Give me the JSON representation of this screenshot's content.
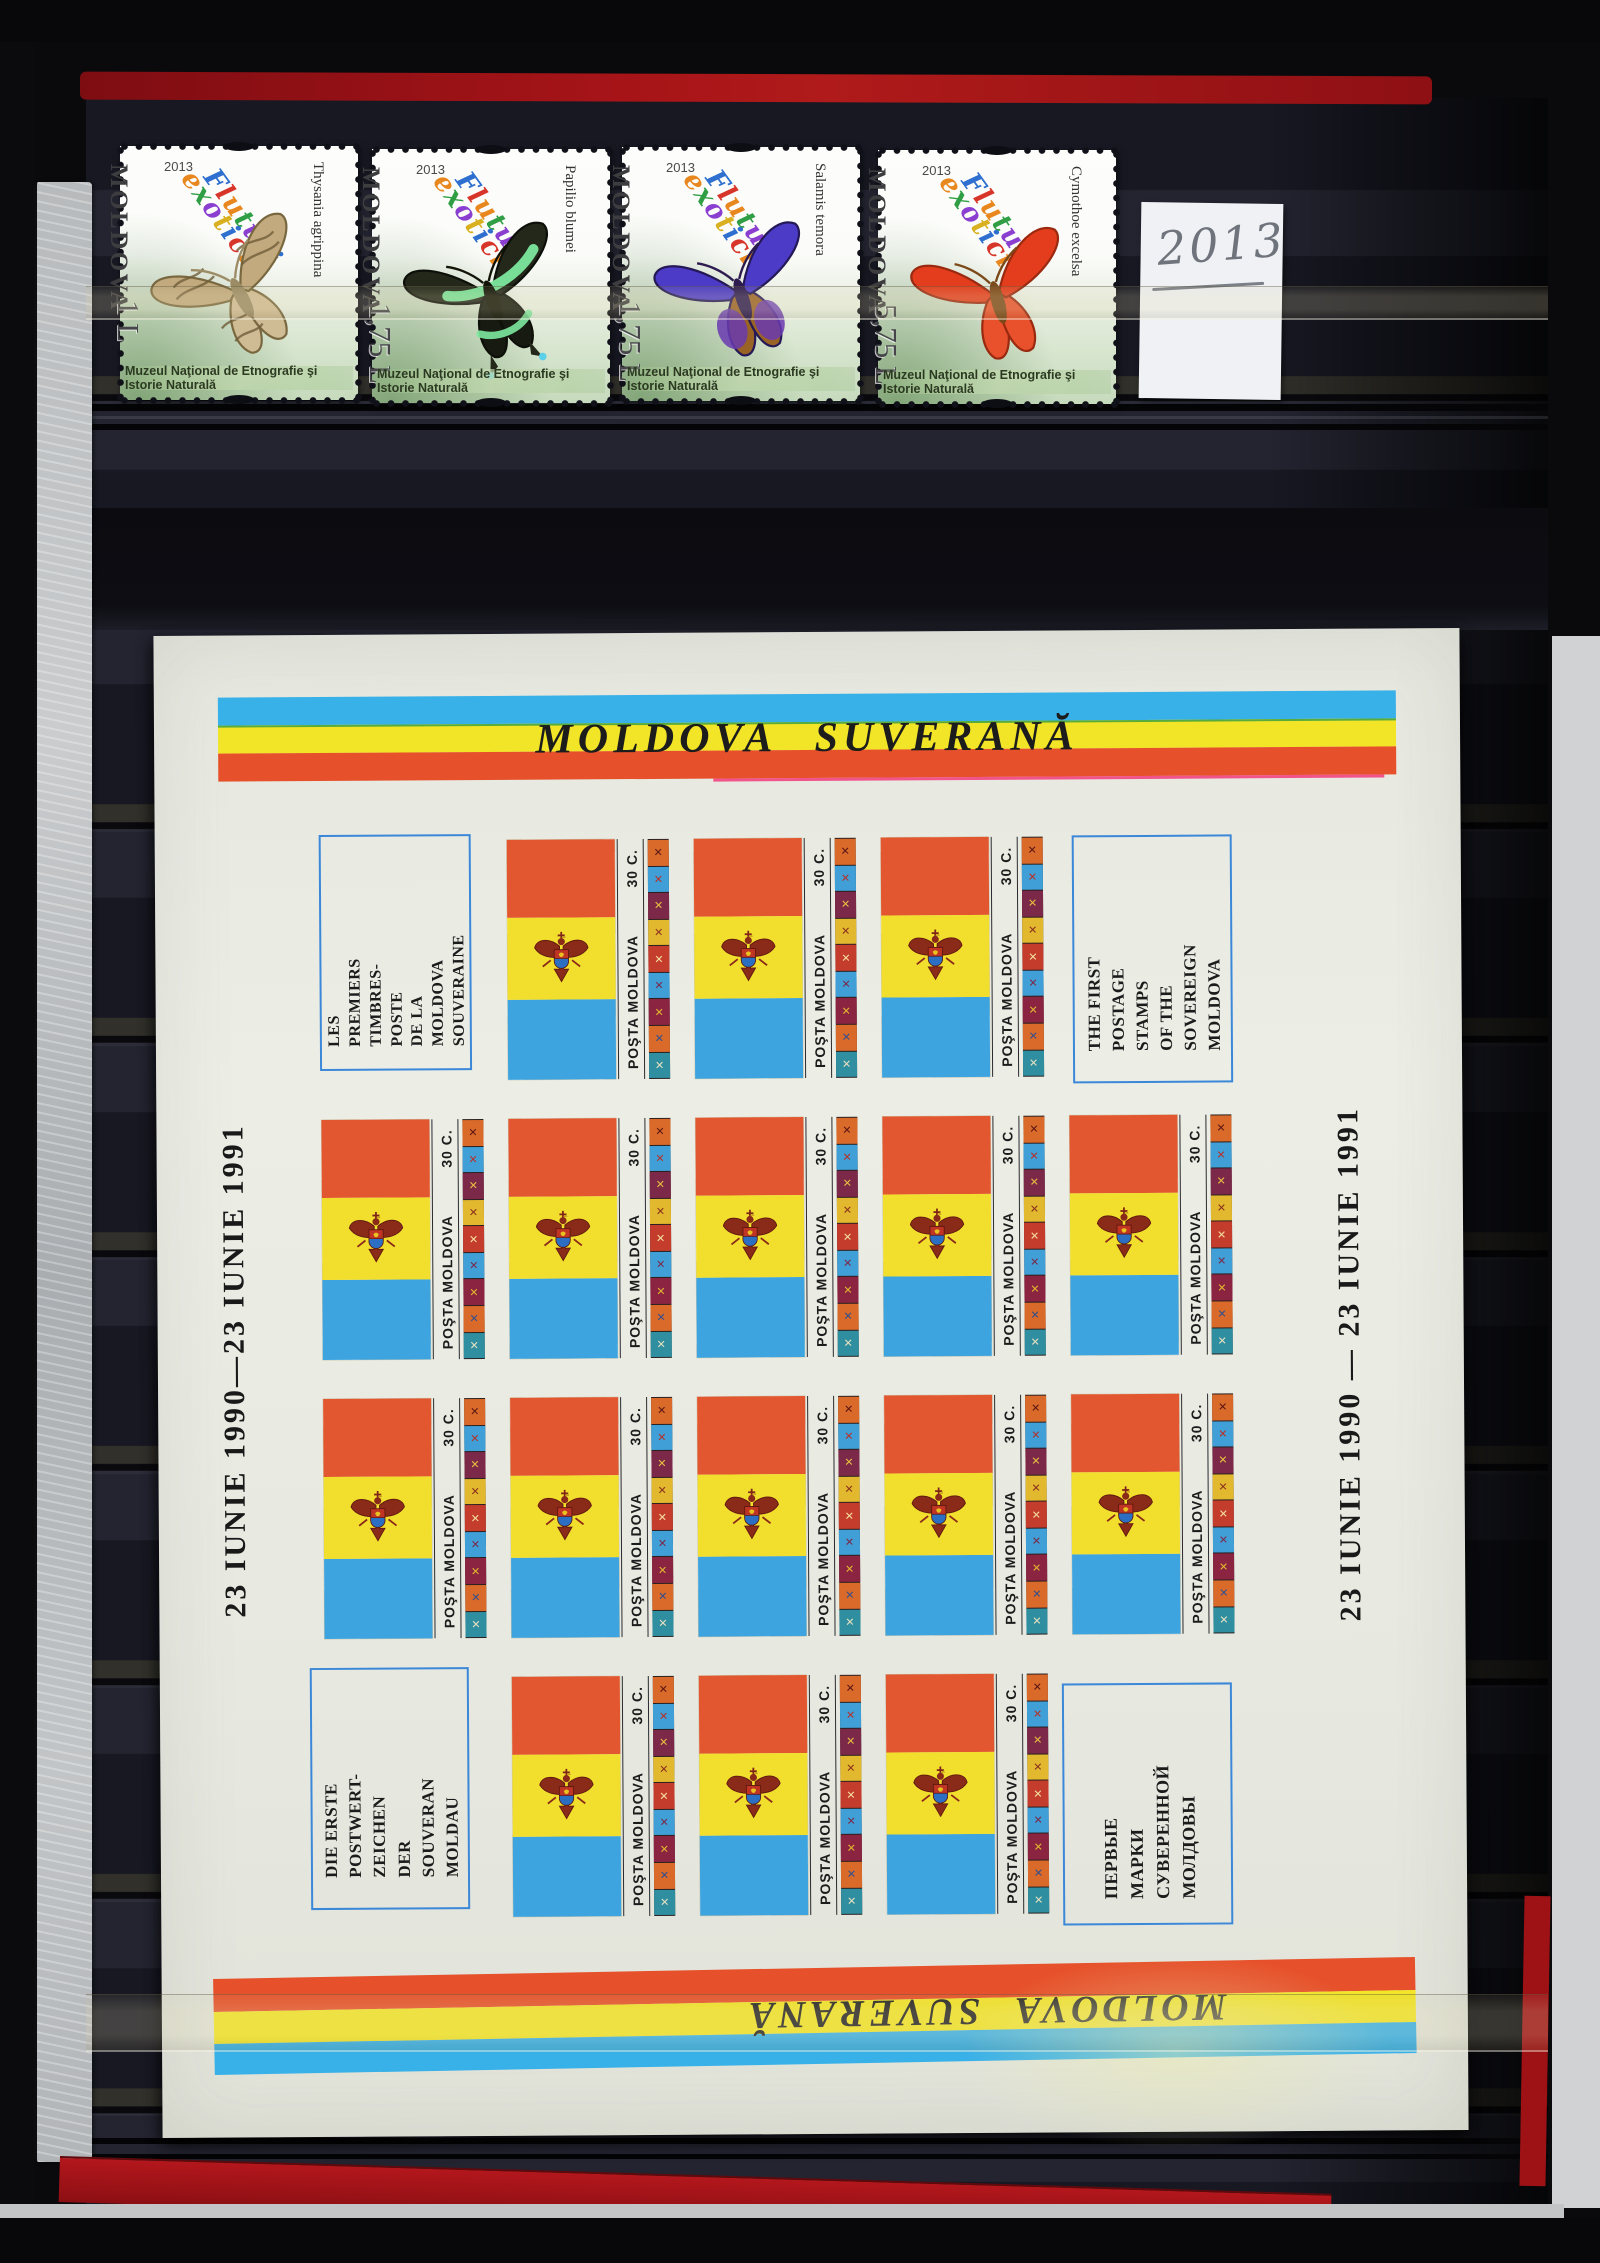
{
  "album_note": {
    "year": "2013"
  },
  "butterfly_series": {
    "country": "MOLDOVA",
    "year": "2013",
    "script_title": [
      "Fluturi",
      "exotici"
    ],
    "museum": "Muzeul Naţional de Etnografie şi Istorie Naturală",
    "stamps": [
      {
        "species": "Thysania agrippina",
        "denomination": "1 L",
        "art": {
          "fw": "#c2a97e",
          "hw": "#cfbb94",
          "stroke": "#79683f",
          "body": "#9c8c66",
          "detail": "#6f5e3a",
          "rotate": -28,
          "pattern": true
        }
      },
      {
        "species": "Papilio blumei",
        "denomination": "1,75 L",
        "art": {
          "fw": "#23281b",
          "hw": "#171a10",
          "stroke": "#0d0f09",
          "body": "#121408",
          "detail": "#7de89e",
          "rotate": -20,
          "band": true,
          "tail": true
        }
      },
      {
        "species": "Salamis temora",
        "denomination": "1,75 L",
        "art": {
          "fw": "#4b3bc6",
          "hw": "#9a6326",
          "hw2": "#6a3ab0",
          "stroke": "#241856",
          "body": "#2e1c50",
          "detail": "#8a5a28",
          "rotate": -18
        }
      },
      {
        "species": "Cymothoe excelsa",
        "denomination": "5,75 L",
        "art": {
          "fw": "#e33d1d",
          "hw": "#e8512c",
          "stroke": "#99290f",
          "body": "#7c4a1a",
          "detail": "#f2e3c2",
          "rotate": -15
        }
      }
    ]
  },
  "sheet": {
    "title_top": "MOLDOVA SUVERANĂ",
    "title_bottom": "MOLDOVA SUVERANĂ",
    "date_left": "23 IUNIE 1990—23 IUNIE 1991",
    "date_right": "23 IUNIE 1990 — 23 IUNIE 1991",
    "corners": {
      "french": [
        "LES",
        "PREMIERS",
        "TIMBRES-",
        "POSTE",
        "DE LA",
        "MOLDOVA",
        "SOUVERAINE"
      ],
      "english": [
        "THE FIRST",
        "POSTAGE",
        "STAMPS",
        "OF THE",
        "SOVEREIGN",
        "MOLDOVA"
      ],
      "german": [
        "DIE ERSTE",
        "POSTWERT-",
        "ZEICHEN",
        "DER",
        "SOUVERAN",
        "MOLDAU"
      ],
      "russian": [
        "ПЕРВЫЕ",
        "МАРКИ",
        "СУВЕРЕННОЙ",
        "МОЛДОВЫ"
      ]
    },
    "flag_stamp": {
      "inscription": "POŞTA MOLDOVA",
      "denomination": "30 C."
    },
    "ornament_glyph": "✕",
    "grid_rows": [
      [
        0,
        1,
        1,
        1,
        0
      ],
      [
        1,
        1,
        1,
        1,
        1
      ],
      [
        1,
        1,
        1,
        1,
        1
      ],
      [
        0,
        1,
        1,
        1,
        0
      ]
    ]
  },
  "palette": {
    "flag_red": "#e2572f",
    "flag_yellow": "#f2de2c",
    "flag_blue": "#3da4df",
    "stripe_blue": "#38b0e8",
    "stripe_yellow": "#f2e426",
    "stripe_red": "#e6512b",
    "green_misprint": "#2f9e44",
    "magenta_misprint": "#f23a7a",
    "pen_blue": "#3b87d8",
    "sheet_paper": "#e9ebe3",
    "cover_red": "#a01318",
    "ornament_cells": [
      "#d96a2a",
      "#3f9fd6",
      "#7c2848",
      "#e2b82e",
      "#c43c2c",
      "#3f9fd6",
      "#8a2440",
      "#d96a2a",
      "#2f8fa0"
    ],
    "ornament_glyph_colors": [
      "#5a1515",
      "#b83028",
      "#e8c040",
      "#8a3020",
      "#f2e0a0",
      "#7c2848",
      "#e2b82e",
      "#2f4f8f",
      "#e8e0c0"
    ],
    "script_letter_colors": [
      "#2e6fd0",
      "#d8352a",
      "#e8871e",
      "#2f9e44",
      "#8a3fd0",
      "#d8b020"
    ]
  }
}
